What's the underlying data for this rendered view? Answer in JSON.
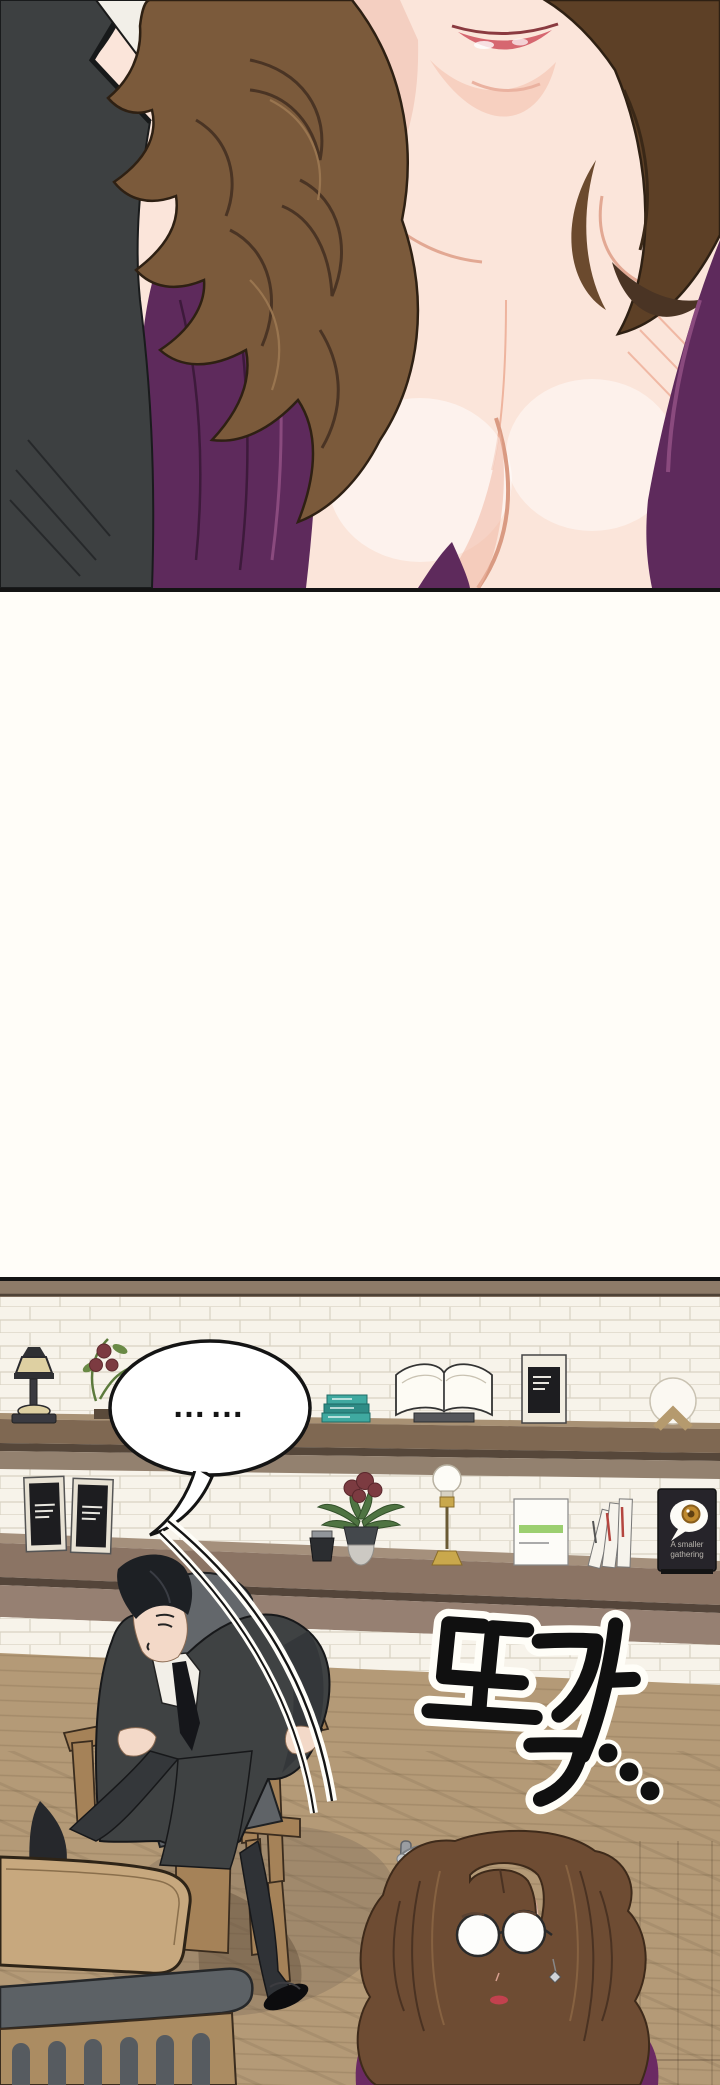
{
  "page": {
    "kind": "webtoon comic page",
    "width": 720,
    "height": 2085,
    "background": "#fffdf8"
  },
  "panel1": {
    "alt": "Close-up of a woman with long curly brown hair in a deep-purple V-neck top; a man in a charcoal suit with white shirt collar stands at the left."
  },
  "panel2": {
    "alt": "Cafe interior with white subway-tile wall, wooden shelves and counter; a man in a dark suit rises from a wooden chair; a woman with round glasses and purple top is seen from above.",
    "speech_bubble": {
      "text": "……"
    },
    "sfx": {
      "text": "또각",
      "trailing": "…"
    },
    "egg_sign": {
      "line1": "A smaller",
      "line2": "gathering"
    }
  },
  "colors": {
    "panel_border": "#141414",
    "suit": "#3d4041",
    "shirt": "#f2efe8",
    "skin": "#fbe5da",
    "skin_shadow": "#f0bfae",
    "lips": "#d4606a",
    "hair_left": "#7b5a3b",
    "hair_right": "#5d4026",
    "dress_purple": "#5e2a5c",
    "tile": "#f7f3ea",
    "tile_line": "#d8d2c2",
    "trim_wood": "#8d7b68",
    "shelf_wood": "#7f6852",
    "shelf_wood_light": "#a89174",
    "shelf_wood_dark": "#56473a",
    "counter_wood": "#8b7464",
    "counter_lower": "#968072",
    "floor": "#b49a77",
    "floor_shadow": "#7a6a58",
    "table": "#c7a87e",
    "bench_cushion": "#5c6165",
    "slat_wood": "#ab8c62",
    "chair_wood": "#a58258",
    "cushion": "#63676b",
    "man_suit": "#3f4243",
    "trouser": "#2f3236",
    "man_hair": "#1d2024",
    "woman_hair": "#6e4c33",
    "woman_top": "#6b2a63",
    "sfx_fill": "#101010",
    "sfx_outline": "#fffef8",
    "brass": "#c9a84c",
    "plant_leaf": "#4f7442",
    "flower": "#7c3b41",
    "teal_book": "#3fa9a0",
    "sign_bg": "#26242a",
    "yolk": "#c08a2e",
    "sign_text": "#b9b5ae"
  }
}
